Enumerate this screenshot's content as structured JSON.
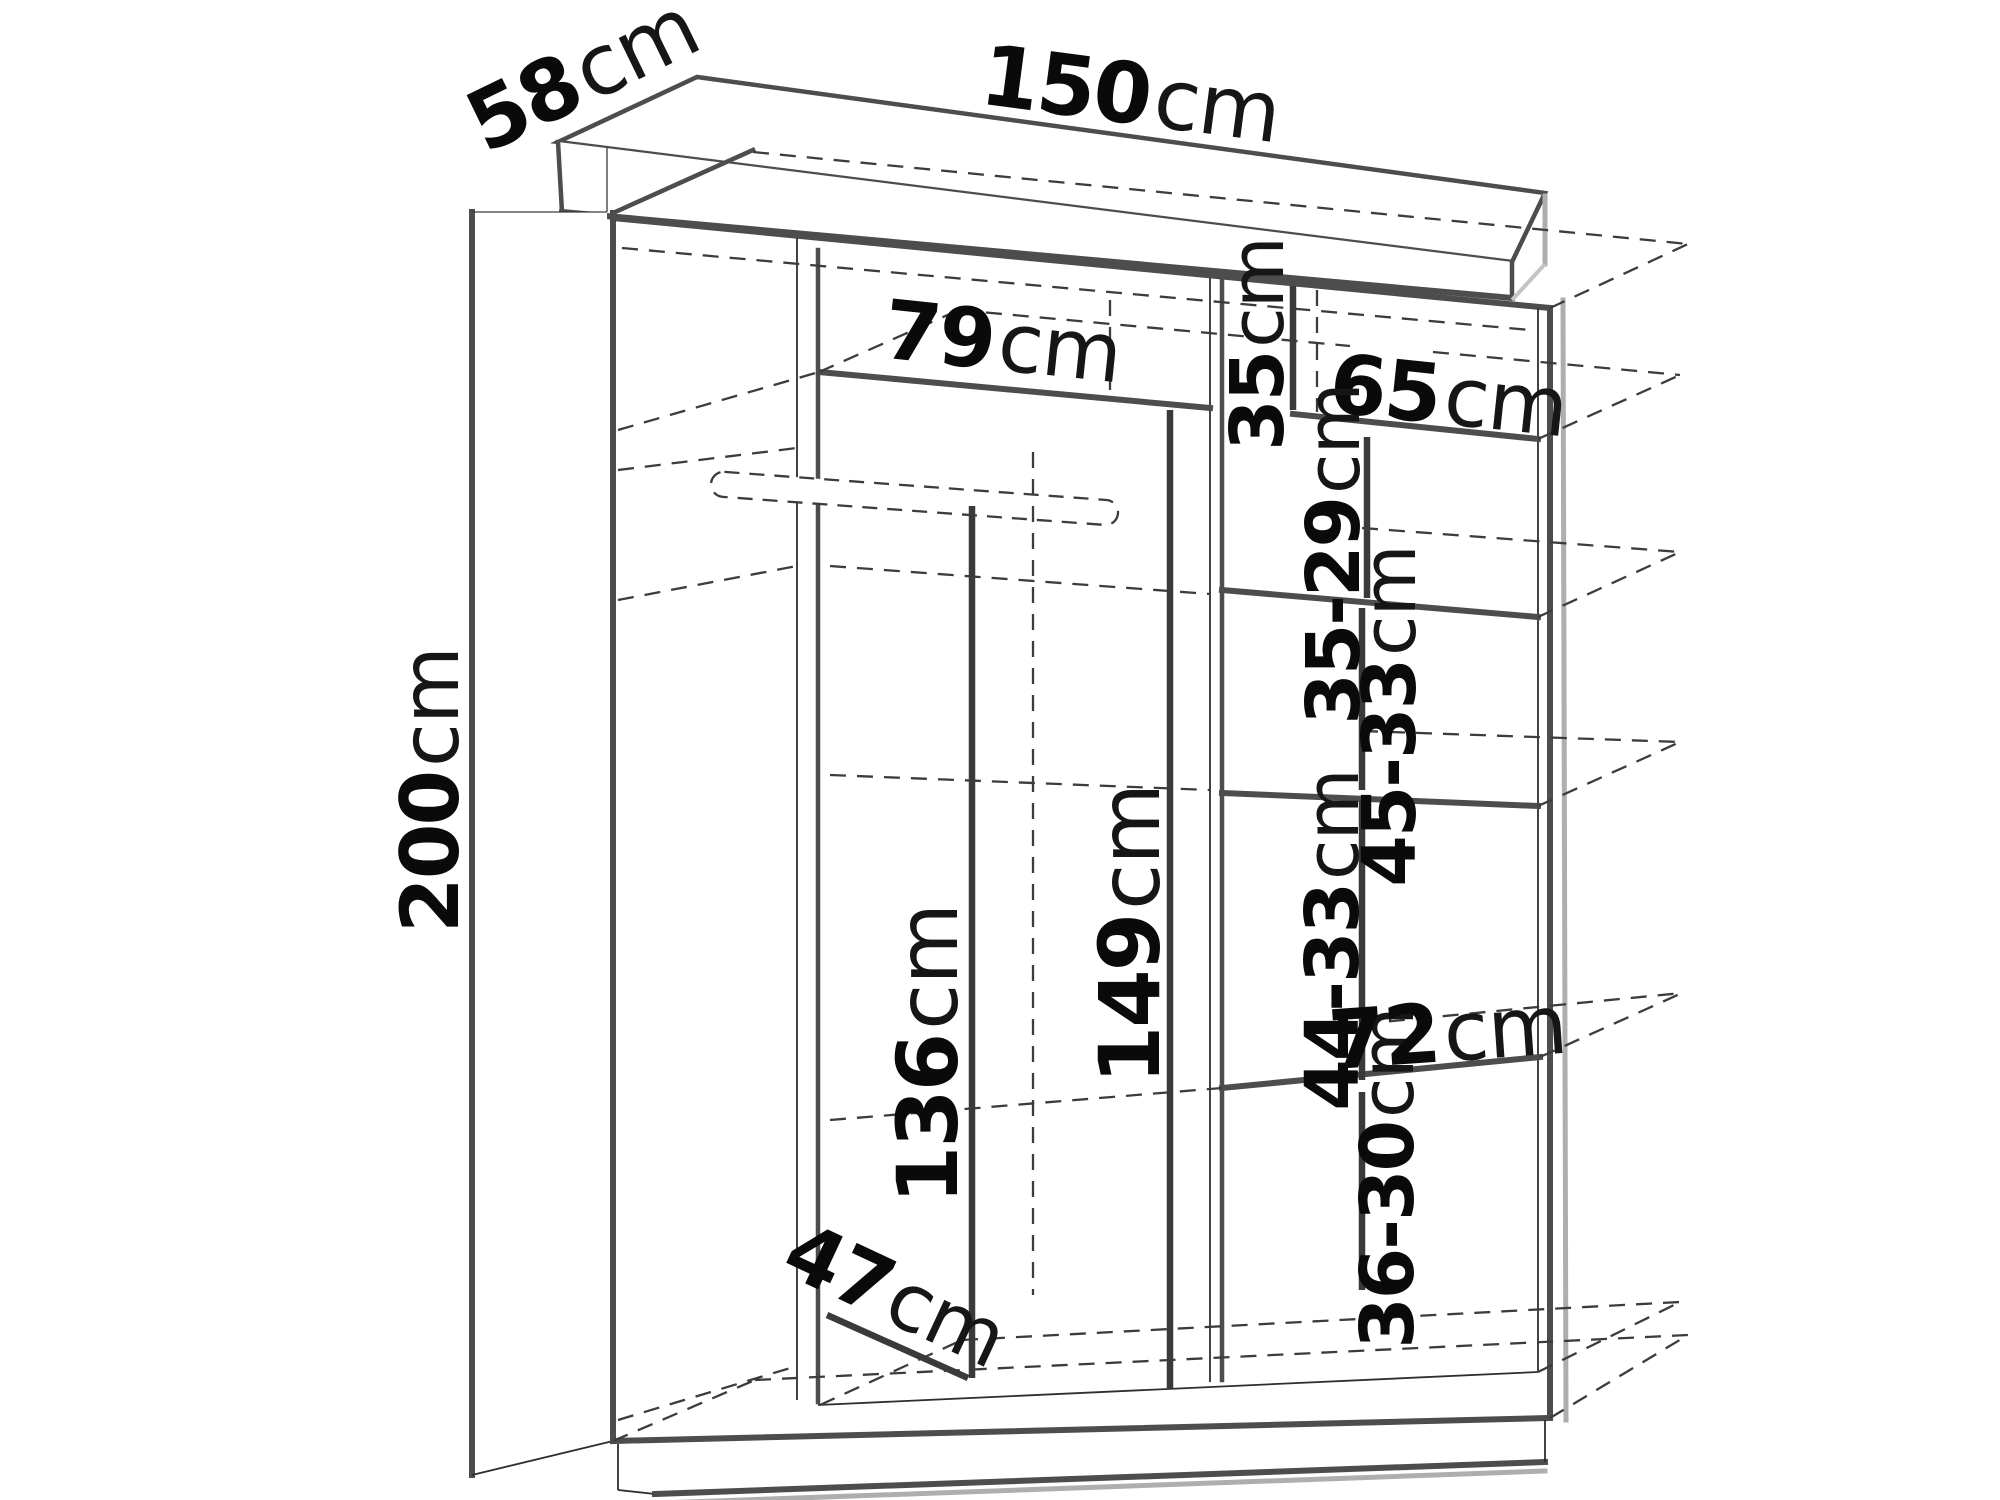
{
  "diagram": {
    "type": "furniture-dimension-drawing",
    "subject": "sliding-door wardrobe interior dimensions",
    "unit": "cm",
    "colors": {
      "background": "#ffffff",
      "line": "#4d4d4d",
      "dashed_line": "#3c3c3c",
      "dimension_line": "#3a3a3a",
      "shadow": "#aeaeae",
      "text": "#0a0a0a"
    }
  },
  "overall": {
    "width": "150",
    "depth": "58",
    "height": "200"
  },
  "dims": {
    "depth": {
      "num": "58",
      "unit": "cm"
    },
    "width": {
      "num": "150",
      "unit": "cm"
    },
    "height": {
      "num": "200",
      "unit": "cm"
    },
    "left_shelf_width": {
      "num": "79",
      "unit": "cm"
    },
    "top_cubby_height": {
      "num": "35",
      "unit": "cm"
    },
    "right_shelf_width": {
      "num": "65",
      "unit": "cm"
    },
    "cubby2_height": {
      "num": "35-29",
      "unit": "cm"
    },
    "cubby3_height": {
      "num": "45-33",
      "unit": "cm"
    },
    "cubby4_height": {
      "num": "44-33",
      "unit": "cm"
    },
    "bottom_cubby_height": {
      "num": "36-30",
      "unit": "cm"
    },
    "bottom_shelf_width": {
      "num": "72",
      "unit": "cm"
    },
    "rail_height": {
      "num": "136",
      "unit": "cm"
    },
    "left_section_height": {
      "num": "149",
      "unit": "cm"
    },
    "interior_depth": {
      "num": "47",
      "unit": "cm"
    }
  }
}
